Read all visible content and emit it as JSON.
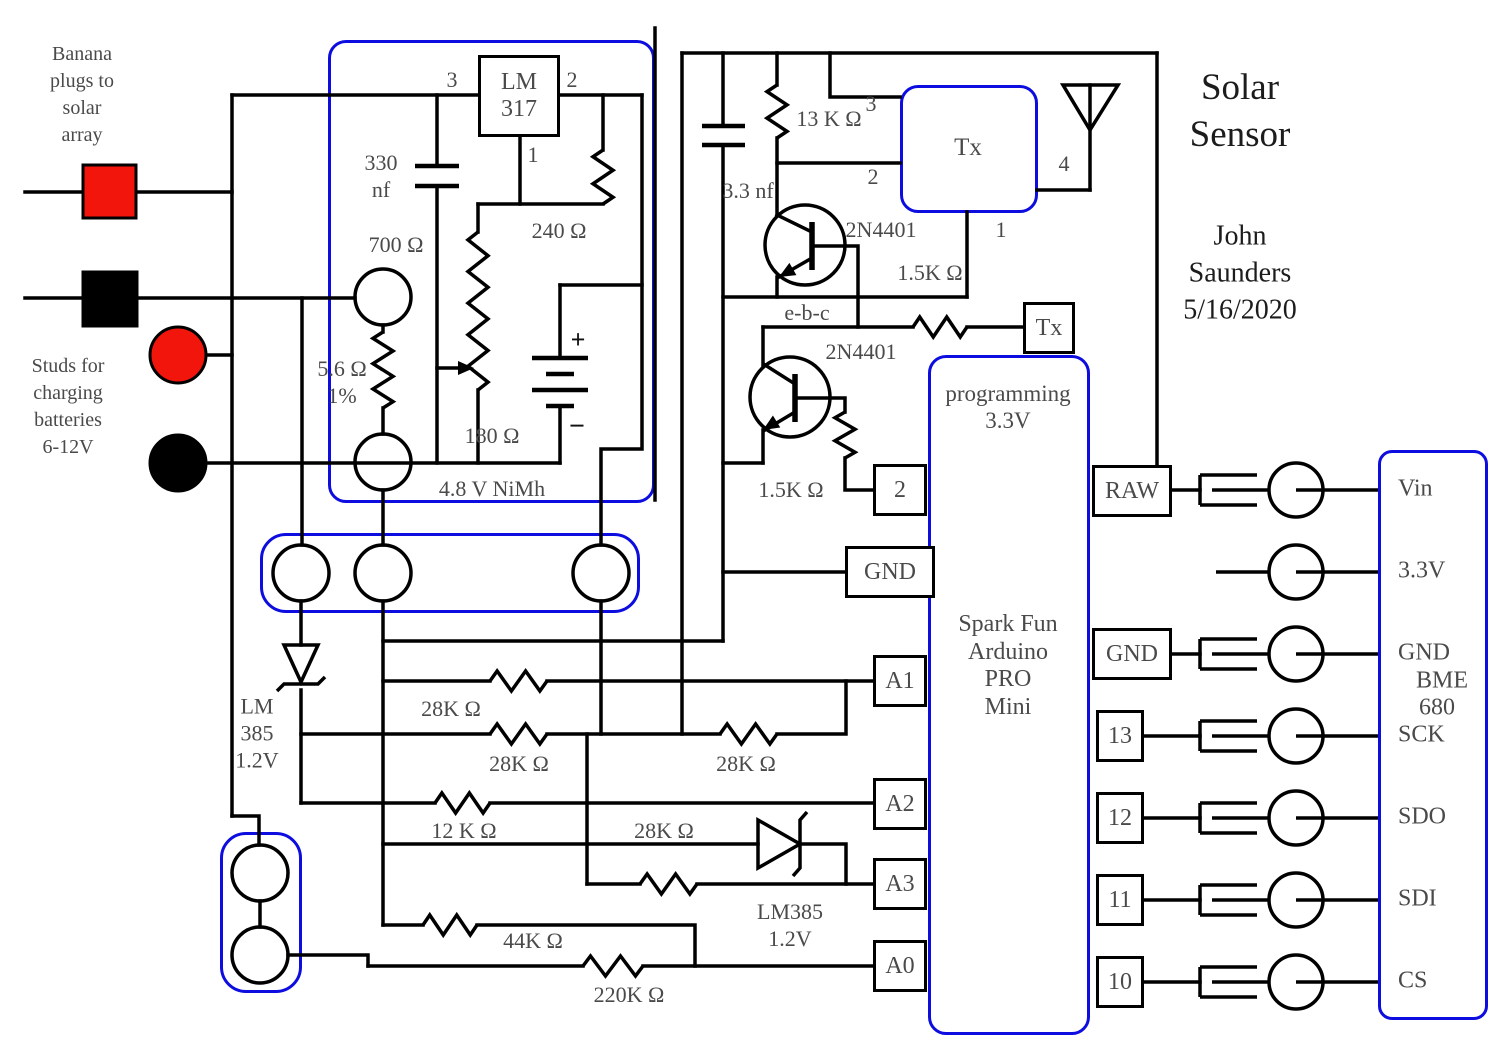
{
  "colors": {
    "wire": "#000000",
    "accent_blue": "#0d0de0",
    "terminal_red": "#f2150c",
    "label_gray": "#4a4a4a"
  },
  "notes": {
    "banana": {
      "l1": "Banana",
      "l2": "plugs to",
      "l3": "solar",
      "l4": "array"
    },
    "studs": {
      "l1": "Studs for",
      "l2": "charging",
      "l3": "batteries",
      "l4": "6-12V"
    }
  },
  "title": {
    "line1": "Solar",
    "line2": "Sensor"
  },
  "author": {
    "line1": "John",
    "line2": "Saunders",
    "line3": "5/16/2020"
  },
  "regulator": {
    "name_line1": "LM",
    "name_line2": "317",
    "pin3": "3",
    "pin2": "2",
    "pin1": "1",
    "cap_line1": "330",
    "cap_line2": "nf",
    "r_240": "240 Ω",
    "r_700": "700 Ω",
    "r_56": "5.6 Ω",
    "r_56_tol": "1%",
    "pot": "180 Ω",
    "battery": "4.8 V NiMh",
    "plus": "+",
    "minus": "−"
  },
  "radio": {
    "cap": "3.3 nf",
    "r_13k": "13 K Ω",
    "tx": "Tx",
    "pin1": "1",
    "pin2": "2",
    "pin3": "3",
    "pin4": "4",
    "q1": "2N4401",
    "q1_r": "1.5K Ω",
    "ebc": "e-b-c",
    "q2": "2N4401",
    "q2_r": "1.5K Ω",
    "tx2": "Tx"
  },
  "arduino": {
    "top_line1": "programming",
    "top_line2": "3.3V",
    "name": [
      "Spark Fun",
      "Arduino",
      "PRO",
      "Mini"
    ],
    "left_pins": [
      "2",
      "GND",
      "A1",
      "A2",
      "A3",
      "A0"
    ],
    "right_pins": [
      "RAW",
      "GND",
      "13",
      "12",
      "11",
      "10"
    ]
  },
  "sensor": {
    "pins": [
      "Vin",
      "3.3V",
      "GND",
      "SCK",
      "SDO",
      "SDI",
      "CS"
    ],
    "name_line1": "BME",
    "name_line2": "680"
  },
  "divider": {
    "zener1_l1": "LM",
    "zener1_l2": "385",
    "zener1_l3": "1.2V",
    "r_28k_a": "28K Ω",
    "r_28k_b": "28K Ω",
    "r_28k_c": "28K Ω",
    "r_12k": "12 K Ω",
    "r_28k_d": "28K Ω",
    "zener2_l1": "LM385",
    "zener2_l2": "1.2V",
    "r_44k": "44K Ω",
    "r_220k": "220K Ω"
  }
}
